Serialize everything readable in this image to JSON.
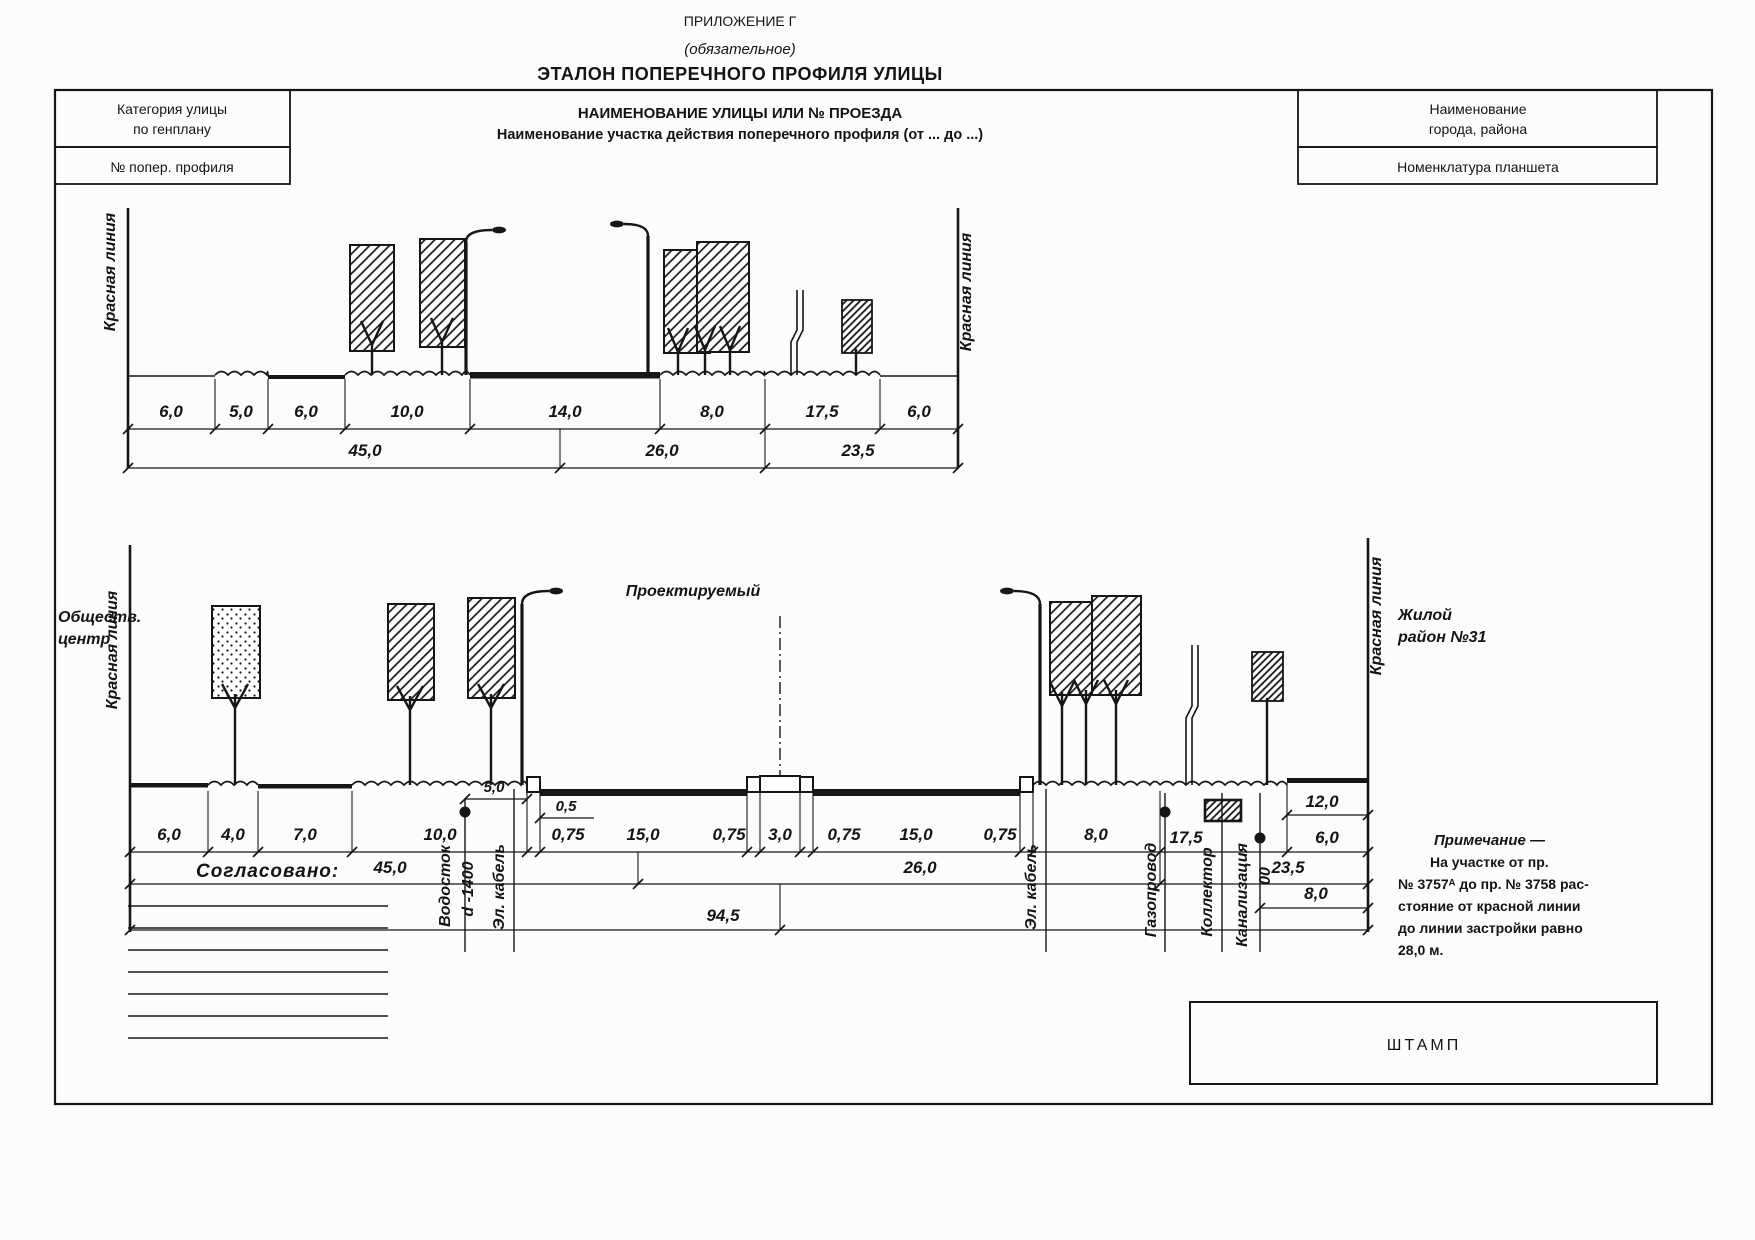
{
  "header": {
    "appendix": "ПРИЛОЖЕНИЕ Г",
    "mandatory": "(обязательное)",
    "title": "ЭТАЛОН ПОПЕРЕЧНОГО ПРОФИЛЯ УЛИЦЫ"
  },
  "title_block": {
    "category_line1": "Категория улицы",
    "category_line2": "по генплану",
    "profile_no": "№ попер. профиля",
    "city_line1": "Наименование",
    "city_line2": "города, района",
    "nomenclature": "Номенклатура планшета"
  },
  "street_header": {
    "line1": "НАИМЕНОВАНИЕ УЛИЦЫ ИЛИ № ПРОЕЗДА",
    "line2": "Наименование участка действия поперечного профиля (от ... до ...)"
  },
  "labels": {
    "red_line": "Красная линия",
    "public_center_line1": "Обществ.",
    "public_center_line2": "центр",
    "residential_line1": "Жилой",
    "residential_line2": "район №31",
    "designed": "Проектируемый",
    "agreed": "Согласовано:",
    "stamp": "ШТАМП"
  },
  "upper_profile": {
    "dims": [
      "6,0",
      "5,0",
      "6,0",
      "10,0",
      "14,0",
      "8,0",
      "17,5",
      "6,0"
    ],
    "totals": [
      "45,0",
      "26,0",
      "23,5"
    ]
  },
  "lower_profile": {
    "dims": [
      "6,0",
      "4,0",
      "7,0",
      "10,0",
      "0,75",
      "15,0",
      "0,75",
      "3,0",
      "0,75",
      "15,0",
      "0,75",
      "8,0",
      "17,5",
      "6,0"
    ],
    "totals": [
      "45,0",
      "26,0",
      "23,5"
    ],
    "grand_total": "94,5",
    "dim_5": "5,0",
    "dim_05": "0,5",
    "dim_12": "12,0",
    "dim_8_right": "8,0"
  },
  "utilities": {
    "water": "Водосток",
    "water_d": "d -1400",
    "cable_left": "Эл. кабель",
    "cable_right": "Эл. кабель",
    "gas": "Газопровод",
    "collector": "Коллектор",
    "sewer": "Канализация",
    "sewer_d": "00"
  },
  "note": {
    "title": "Примечание  —",
    "lines": [
      "На  участке  от  пр.",
      "№ 3757ᴬ до пр. № 3758 рас-",
      "стояние от красной линии",
      "до линии застройки равно",
      "28,0 м."
    ]
  }
}
